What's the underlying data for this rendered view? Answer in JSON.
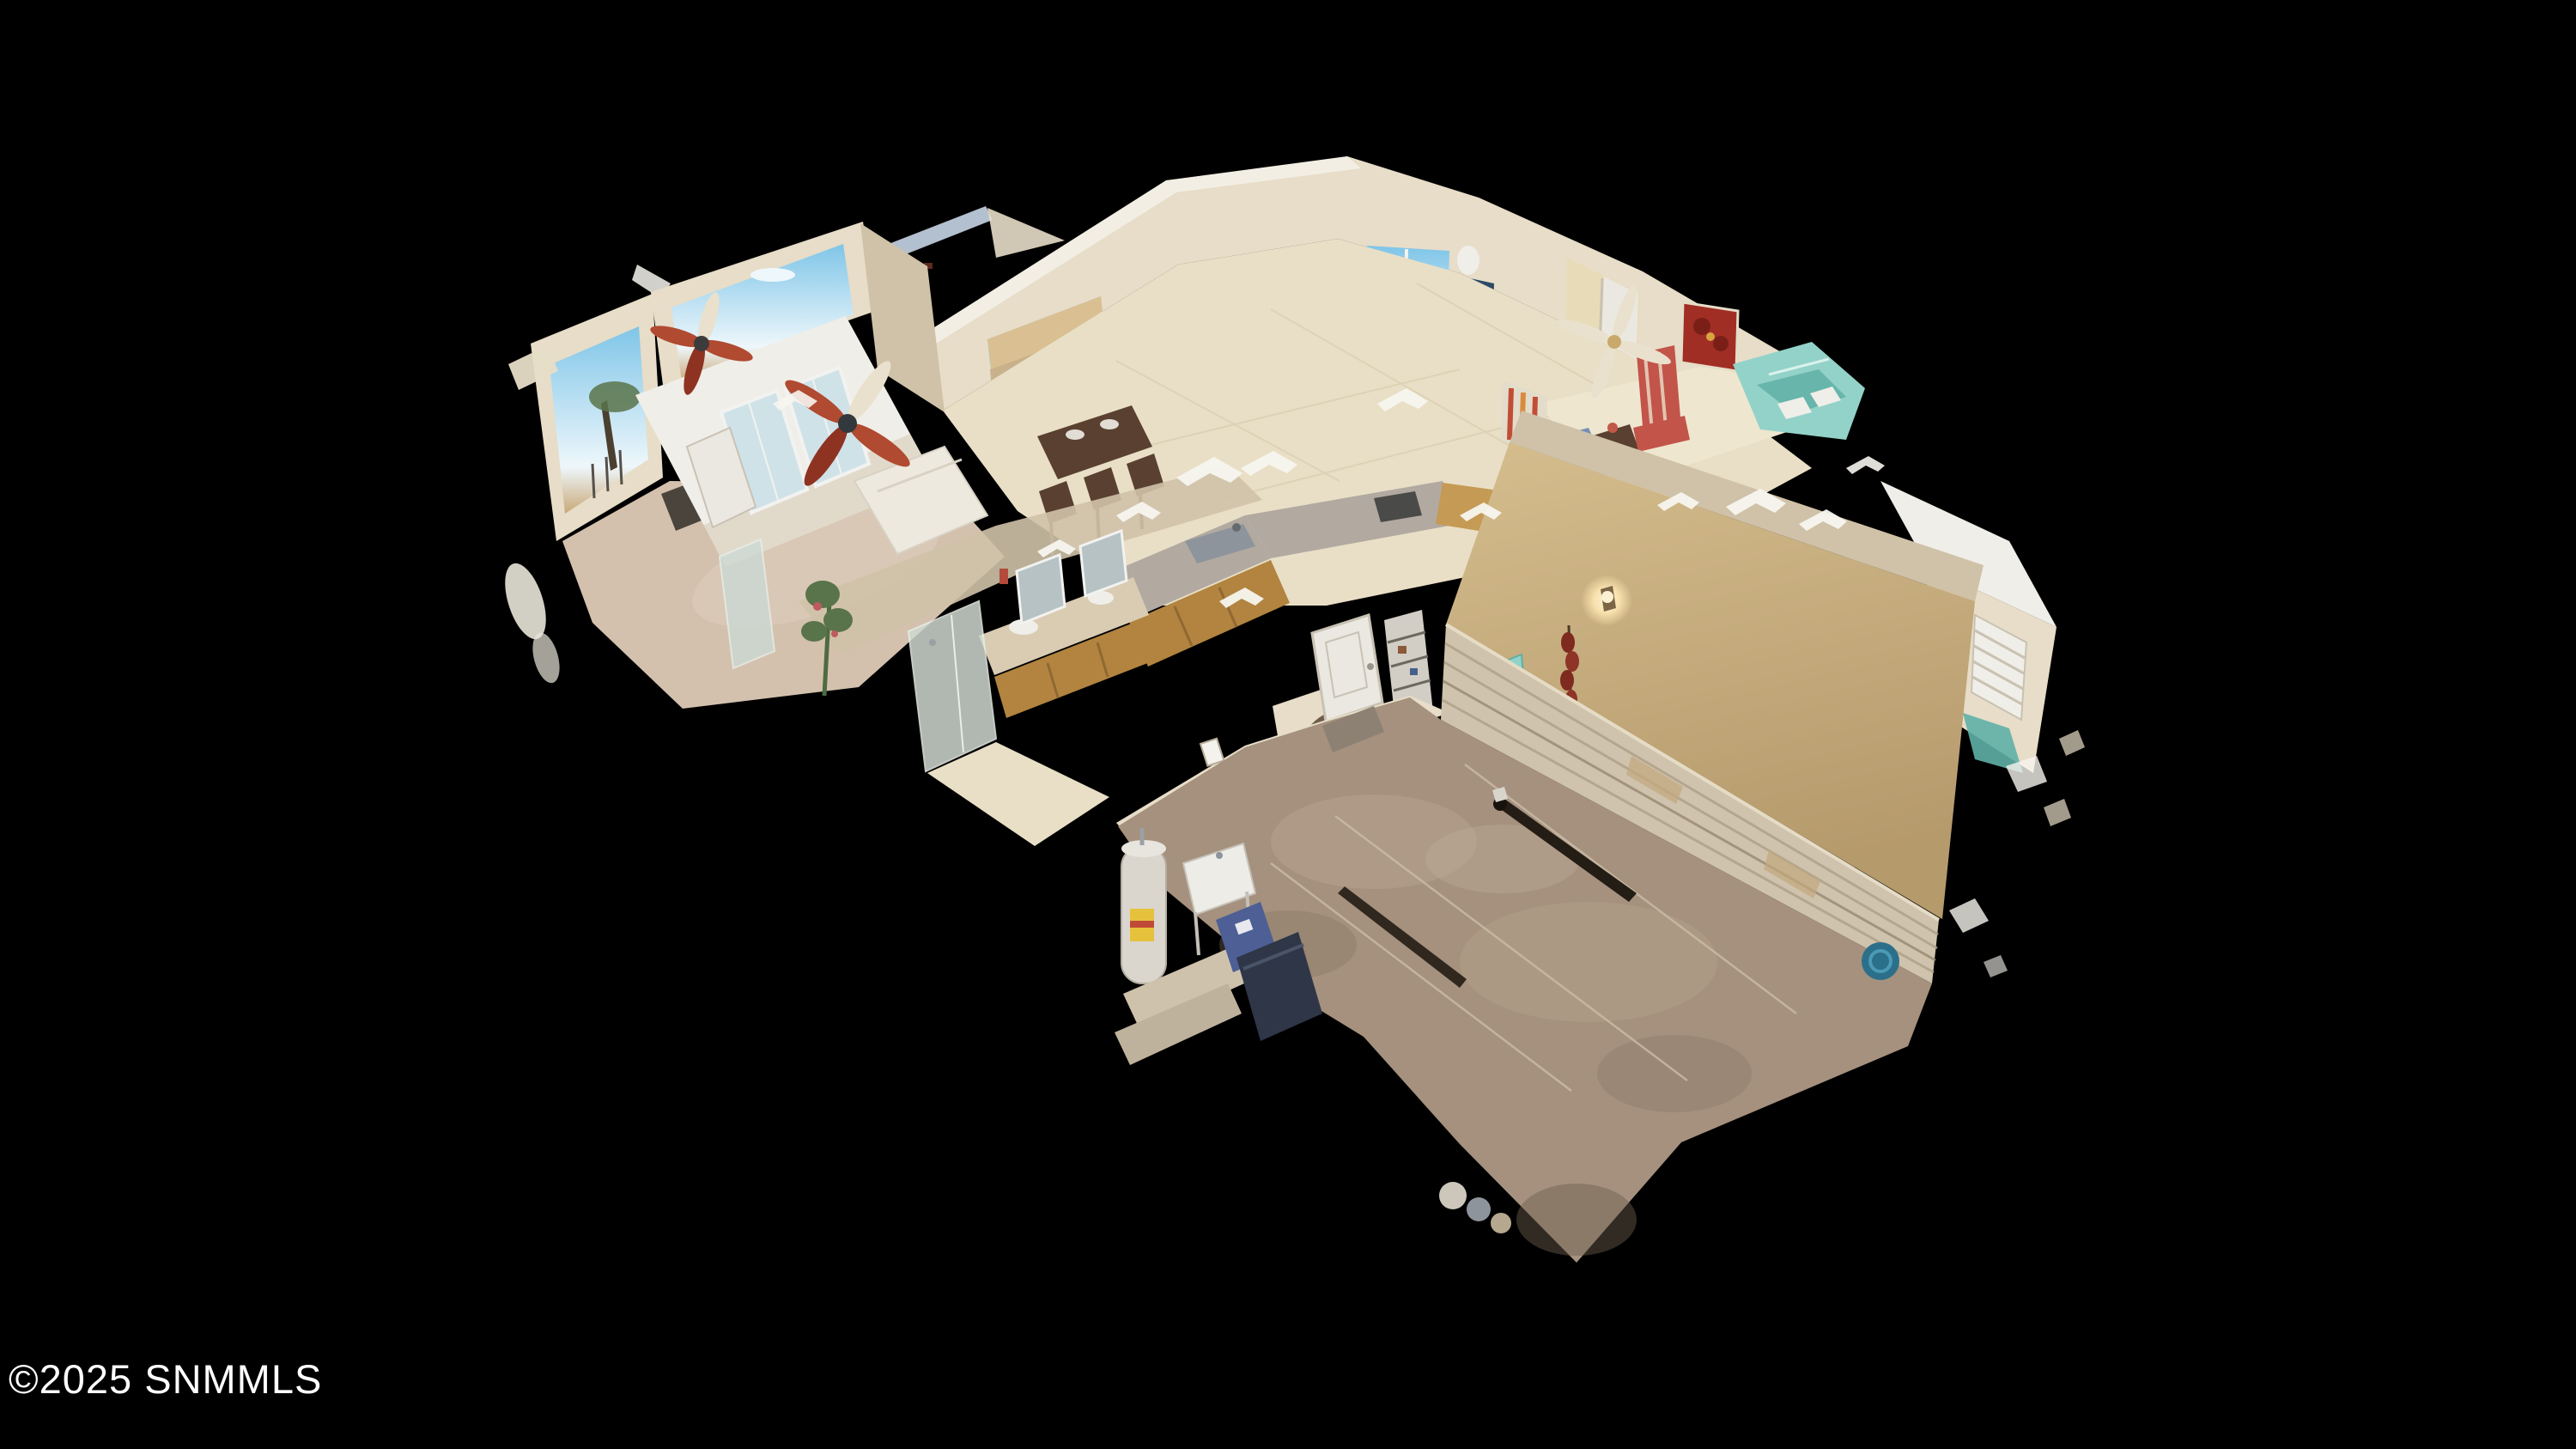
{
  "watermark": {
    "text": "©2025 SNMMLS",
    "color": "#ffffff"
  },
  "scene": {
    "type": "3d-dollhouse-scan",
    "description": "Overhead cutaway dollhouse view of a scanned single-story southwestern home with attached garage, floating on a black background",
    "rooms_visible": [
      "master bedroom",
      "great room",
      "kitchen",
      "dining nook",
      "sitting room",
      "bathroom",
      "laundry room",
      "hallway",
      "garage"
    ]
  },
  "palette": {
    "bg": "#000000",
    "wm": "#ffffff",
    "cream": "#e7ddc8",
    "creamShade": "#cfc2a8",
    "creamDark": "#b9ac92",
    "white": "#f0eee8",
    "whiteCap": "#f7f5ef",
    "tanWall": "#d5bd8e",
    "tanShade": "#b59a6c",
    "tileFloor": "#e9dfc6",
    "tileLight": "#efe6cf",
    "carpet": "#d3c1ae",
    "garageFloor": "#a5917e",
    "garageLight": "#b7a48f",
    "garageDark": "#84725f",
    "granite": "#b2a9a1",
    "woodCabinet": "#b2843f",
    "woodLight": "#c59a55",
    "woodDark": "#5a4030",
    "sky": "#7fc5e8",
    "cloud": "#eef7fb",
    "desertGround": "#c9a878",
    "foliage": "#59744a",
    "doorGlass": "#cfe2e8",
    "teal": "#93d2c8",
    "tealDark": "#5fb0a6",
    "sofaBlue": "#8ca3c5",
    "sofaBlueDark": "#7590b5",
    "chairRed": "#c2544a",
    "paintingRed": "#a12e24",
    "fanRust": "#b04a30",
    "fanRustDark": "#8e3322",
    "beamGray": "#b3c0cf",
    "doorWhite": "#eae8e1",
    "metalGray": "#8d949c",
    "binBlue": "#4d5f95",
    "binDark": "#2f3647",
    "lampGlow": "#f7e0ac",
    "ristraRed": "#7e2a1f",
    "leatherChair": "#a35f3e",
    "openingShadow": "#6e5d49",
    "floorTrench": "#241d15",
    "hutchBlue": "#2b4a66",
    "fanLight": "#e9e1cd"
  }
}
